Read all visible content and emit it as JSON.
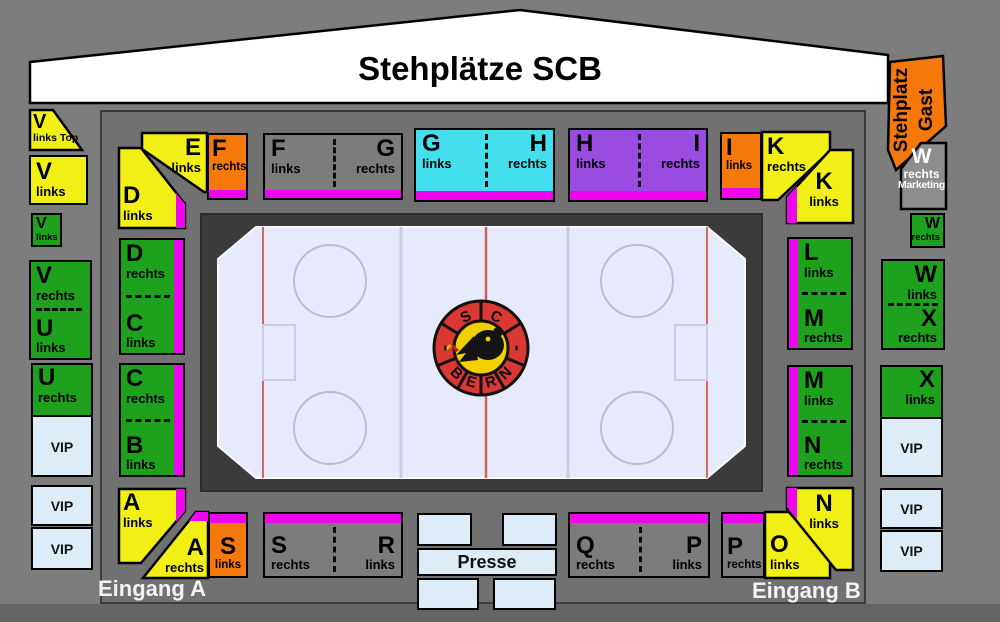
{
  "title_banner": {
    "label": "Stehplätze SCB"
  },
  "entrances": {
    "a": "Eingang A",
    "b": "Eingang B"
  },
  "gast": {
    "line1": "Stehplatz",
    "line2": "Gast"
  },
  "marketing": {
    "letter": "W",
    "sub": "rechts",
    "name": "Marketing"
  },
  "labels": {
    "vip": "VIP",
    "presse": "Presse"
  },
  "logo": {
    "top": {
      "s": "S",
      "c": "C"
    },
    "bottom": {
      "b": "B",
      "e": "E",
      "r": "R",
      "n": "N"
    },
    "dash": "-"
  },
  "sections": {
    "v_links_top": {
      "letter": "V",
      "sub": "links Top"
    },
    "v_links_outer": {
      "letter": "V",
      "sub": "links"
    },
    "v_links_small": {
      "letter": "V",
      "sub": "links"
    },
    "v_rechts": {
      "letter": "V",
      "sub": "rechts"
    },
    "u_links": {
      "letter": "U",
      "sub": "links"
    },
    "u_rechts": {
      "letter": "U",
      "sub": "rechts"
    },
    "d_links": {
      "letter": "D",
      "sub": "links"
    },
    "d_rechts": {
      "letter": "D",
      "sub": "rechts"
    },
    "c_links": {
      "letter": "C",
      "sub": "links"
    },
    "c_rechts": {
      "letter": "C",
      "sub": "rechts"
    },
    "b_links": {
      "letter": "B",
      "sub": "links"
    },
    "a_links": {
      "letter": "A",
      "sub": "links"
    },
    "a_rechts": {
      "letter": "A",
      "sub": "rechts"
    },
    "s_links": {
      "letter": "S",
      "sub": "links"
    },
    "s_rechts": {
      "letter": "S",
      "sub": "rechts"
    },
    "r_links": {
      "letter": "R",
      "sub": "links"
    },
    "q_rechts": {
      "letter": "Q",
      "sub": "rechts"
    },
    "p_links": {
      "letter": "P",
      "sub": "links"
    },
    "p_rechts": {
      "letter": "P",
      "sub": "rechts"
    },
    "o_links": {
      "letter": "O",
      "sub": "links"
    },
    "e_links": {
      "letter": "E",
      "sub": "links"
    },
    "f_rechts": {
      "letter": "F",
      "sub": "rechts"
    },
    "f_links": {
      "letter": "F",
      "sub": "links"
    },
    "g_rechts": {
      "letter": "G",
      "sub": "rechts"
    },
    "g_links": {
      "letter": "G",
      "sub": "links"
    },
    "h_rechts": {
      "letter": "H",
      "sub": "rechts"
    },
    "h_links": {
      "letter": "H",
      "sub": "links"
    },
    "i_rechts": {
      "letter": "I",
      "sub": "rechts"
    },
    "i_links": {
      "letter": "I",
      "sub": "links"
    },
    "k_rechts": {
      "letter": "K",
      "sub": "rechts"
    },
    "k_links": {
      "letter": "K",
      "sub": "links"
    },
    "l_links": {
      "letter": "L",
      "sub": "links"
    },
    "m_rechts": {
      "letter": "M",
      "sub": "rechts"
    },
    "m_links": {
      "letter": "M",
      "sub": "links"
    },
    "n_rechts": {
      "letter": "N",
      "sub": "rechts"
    },
    "n_links": {
      "letter": "N",
      "sub": "links"
    },
    "w_rechts_small": {
      "letter": "W",
      "sub": "rechts"
    },
    "w_links": {
      "letter": "W",
      "sub": "links"
    },
    "x_rechts": {
      "letter": "X",
      "sub": "rechts"
    },
    "x_links": {
      "letter": "X",
      "sub": "links"
    }
  },
  "colors": {
    "yellow": "#f2ef17",
    "green": "#1ea21e",
    "orange": "#f5780a",
    "magenta": "#ee07ee",
    "cyan": "#44dfee",
    "purple": "#9a4be0",
    "vip_blue": "#dcedf8",
    "ice": "#e7eafa",
    "rink_dark": "#3b3b3b",
    "bowl_gray": "#717171",
    "page_gray": "#7d7d7d",
    "banner_white": "#ffffff",
    "logo_red": "#da3832",
    "logo_yellow": "#f2cf00"
  }
}
